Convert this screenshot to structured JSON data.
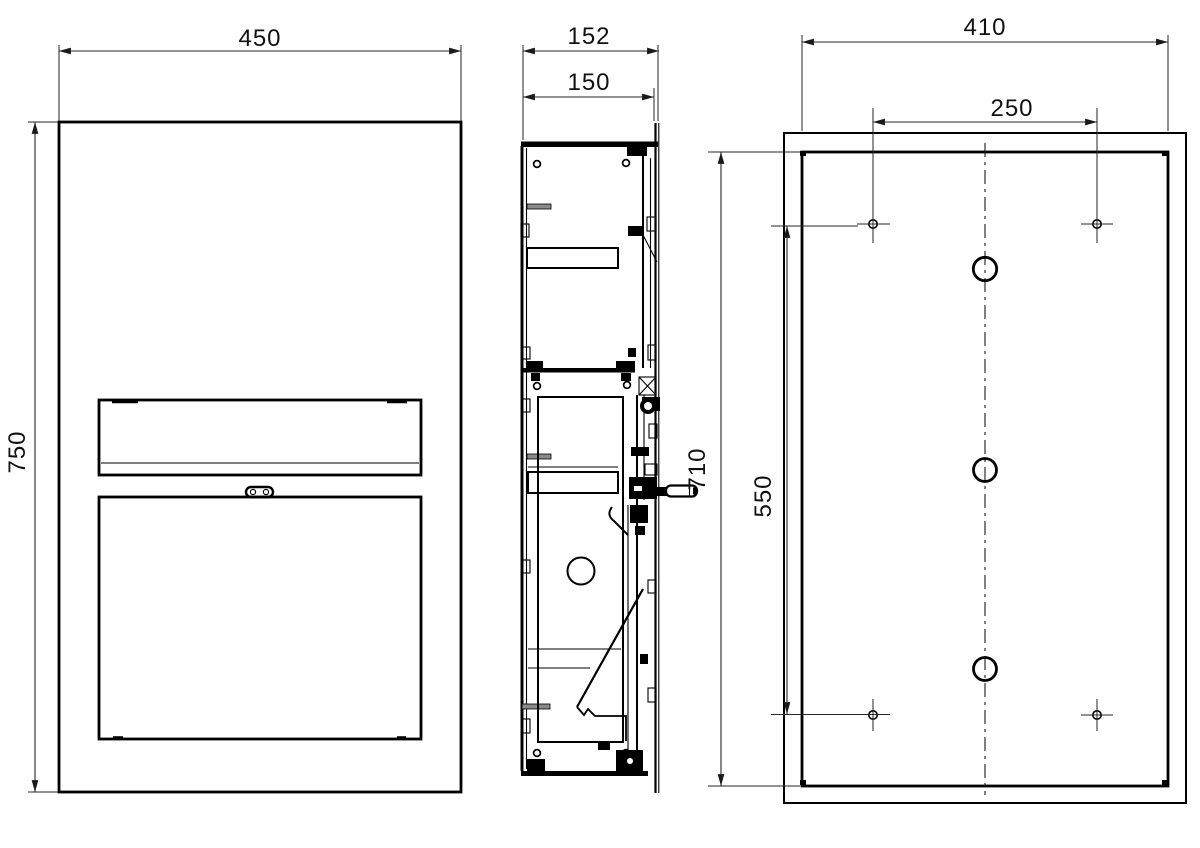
{
  "drawing": {
    "type": "technical-orthographic-views",
    "views": [
      "front",
      "side-section",
      "rear"
    ]
  },
  "dimensions": {
    "front_width": "450",
    "front_height": "750",
    "side_overall_depth": "152",
    "side_recess_depth": "150",
    "rear_box_height": "710",
    "rear_hole_vertical_spacing": "550",
    "rear_box_width": "410",
    "rear_hole_horizontal_spacing": "250"
  },
  "colors": {
    "line": "#000000",
    "dimension_line": "#262626",
    "background": "#ffffff"
  }
}
